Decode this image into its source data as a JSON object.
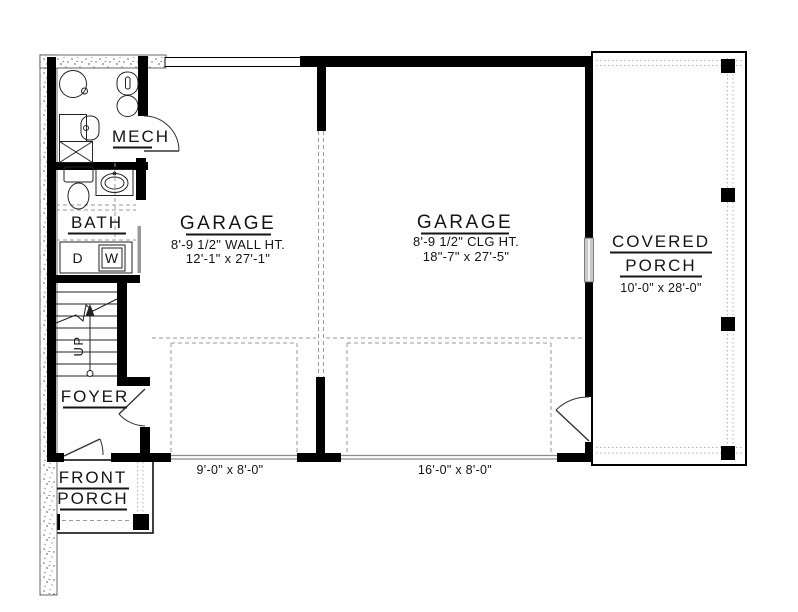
{
  "rooms": {
    "mech": {
      "label": "MECH"
    },
    "bath": {
      "label": "BATH"
    },
    "foyer": {
      "label": "FOYER"
    },
    "stairs": {
      "label": "UP"
    },
    "garage1": {
      "name": "GARAGE",
      "height_note": "8'-9 1/2\" WALL HT.",
      "size": "12'-1\" x 27'-1\""
    },
    "garage2": {
      "name": "GARAGE",
      "height_note": "8'-9 1/2\" CLG HT.",
      "size": "18\"-7\" x 27'-5\""
    },
    "covered_porch": {
      "name_line1": "COVERED",
      "name_line2": "PORCH",
      "size": "10'-0\" x 28'-0\""
    },
    "front_porch": {
      "name_line1": "FRONT",
      "name_line2": "PORCH"
    }
  },
  "appliances": {
    "dryer": "D",
    "washer": "W"
  },
  "garage_doors": {
    "door1_size": "9'-0\" x 8'-0\"",
    "door2_size": "16'-0\" x 8'-0\""
  },
  "colors": {
    "wall": "#000000",
    "dashed_line": "#9a9a9a",
    "glass": "#c8c8c8"
  }
}
